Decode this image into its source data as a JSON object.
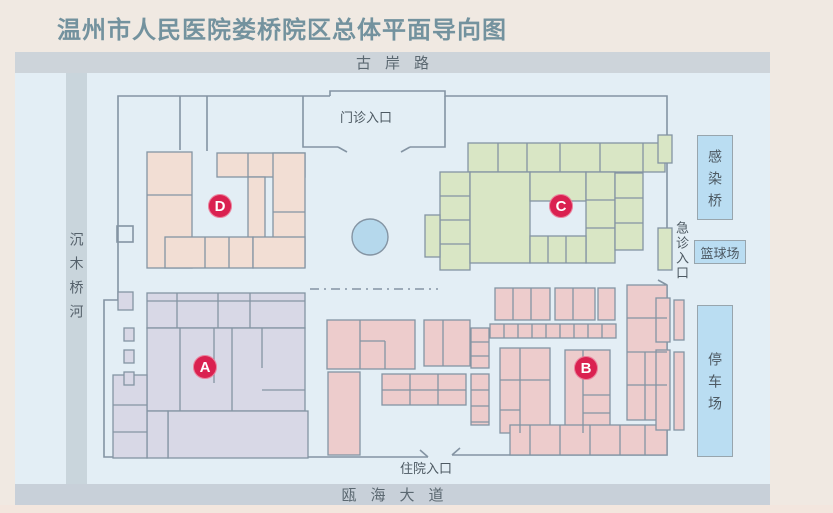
{
  "title": "温州市人民医院娄桥院区总体平面导向图",
  "roads": {
    "north": "古岸路",
    "south": "瓯海大道",
    "west_river": "沉木桥河"
  },
  "entrances": {
    "outpatient": "门诊入口",
    "emergency": "急诊入口",
    "inpatient": "住院入口"
  },
  "facilities": {
    "infection_bridge": "感染桥",
    "basketball_court": "篮球场",
    "parking_lot": "停车场"
  },
  "buildings": [
    {
      "id": "A",
      "fill": "#d8d8e6"
    },
    {
      "id": "B",
      "fill": "#edcccc"
    },
    {
      "id": "C",
      "fill": "#d9e6c5"
    },
    {
      "id": "D",
      "fill": "#f2ded4"
    }
  ],
  "colors": {
    "badge": "#da2150",
    "page_background": "#f0e9e2",
    "map_background": "#e3eef5",
    "road_band": "#cdd4da",
    "outline": "#8494a3",
    "label_box": "#baddf2",
    "pond": "#b5d8ec",
    "title_text": "#73929e",
    "road_text": "#5b6871"
  }
}
